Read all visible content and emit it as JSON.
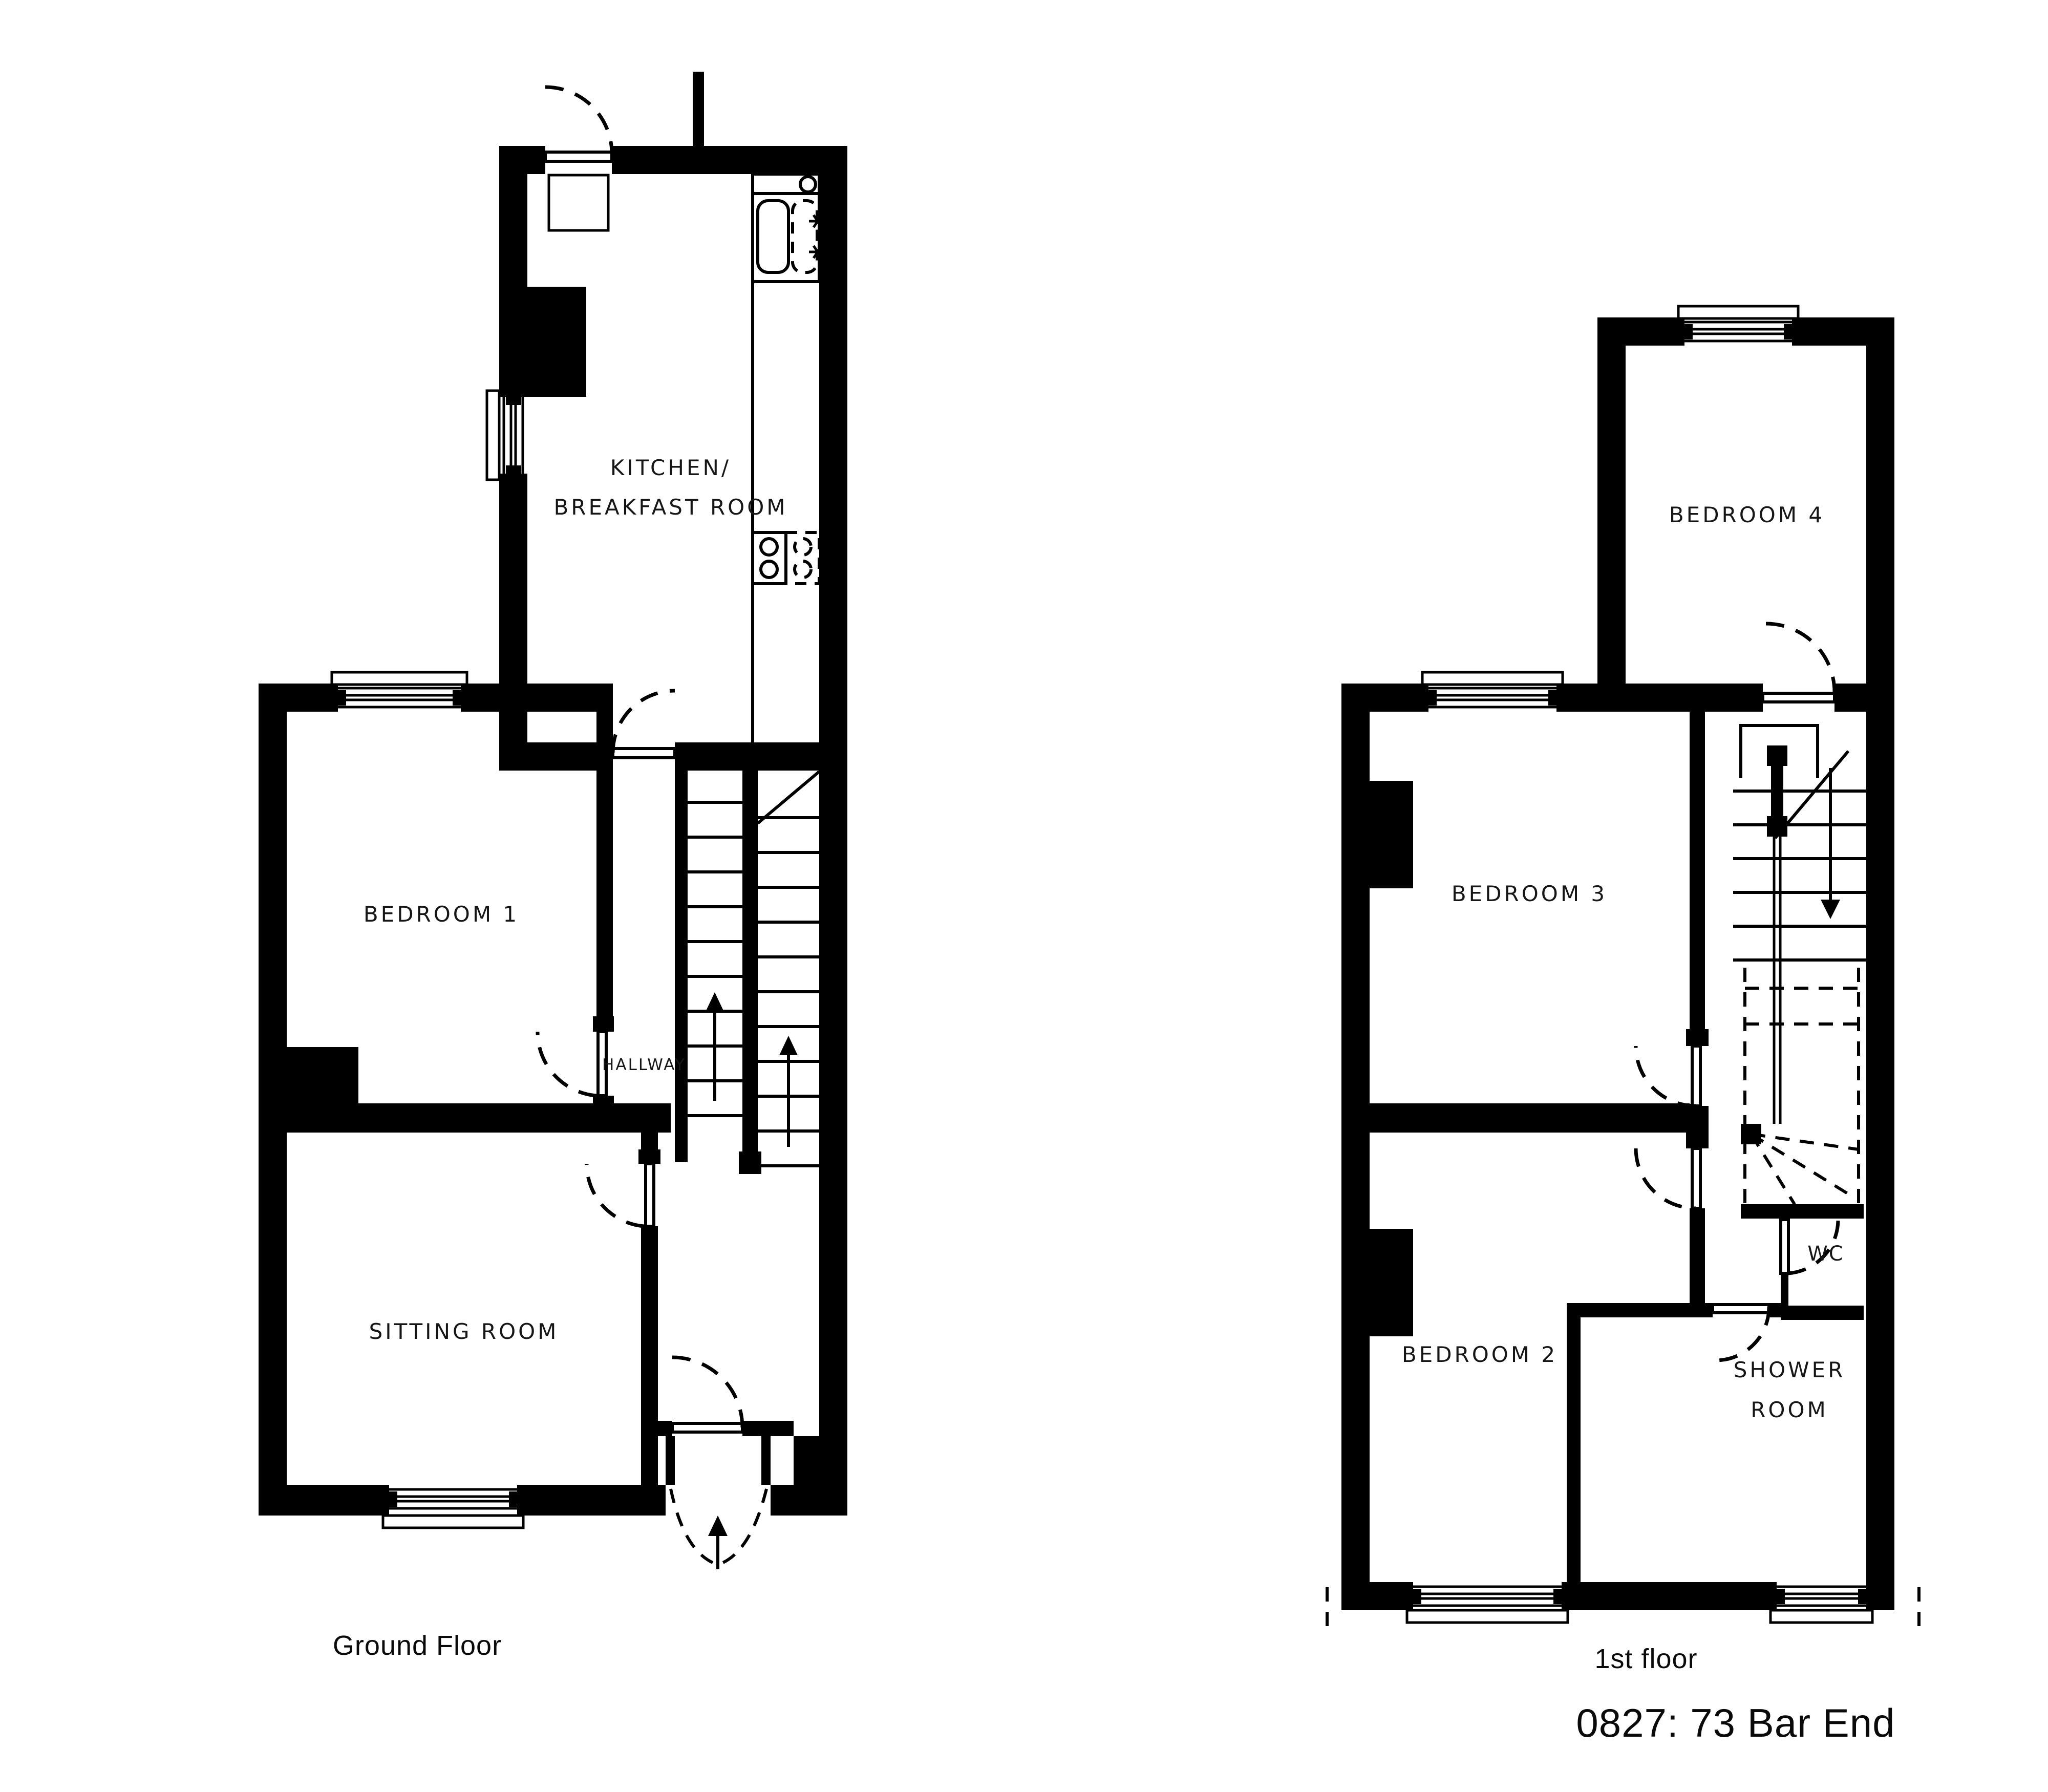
{
  "title": "0827: 73 Bar End",
  "colors": {
    "walls": "#000000",
    "background": "#ffffff",
    "text": "#161616"
  },
  "ground_floor": {
    "caption": "Ground Floor",
    "rooms": {
      "kitchen_line1": "KITCHEN/",
      "kitchen_line2": "BREAKFAST ROOM",
      "bedroom1": "BEDROOM 1",
      "hallway": "HALLWAY",
      "sitting_room": "SITTING ROOM"
    }
  },
  "first_floor": {
    "caption": "1st floor",
    "rooms": {
      "bedroom4": "BEDROOM 4",
      "bedroom3": "BEDROOM 3",
      "bedroom2": "BEDROOM 2",
      "wc": "WC",
      "shower_line1": "SHOWER",
      "shower_line2": "ROOM"
    }
  }
}
